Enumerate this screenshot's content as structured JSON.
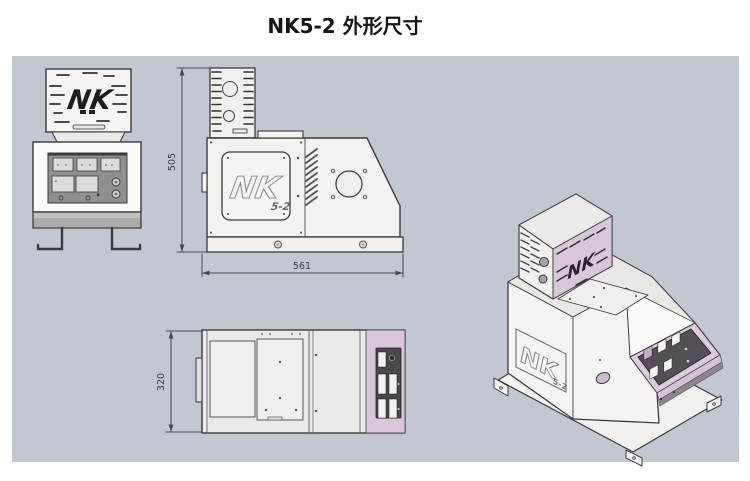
{
  "title": "NK5-2 外形尺寸",
  "brand": {
    "logo": "NK",
    "model": "5-2"
  },
  "dimensions": {
    "height": "505",
    "width": "561",
    "depth": "320"
  },
  "colors": {
    "canvas": "#c3c7d1",
    "lavender": "#d8c7da",
    "panel_gray": "#8f8f8d",
    "dark_panel": "#4b4947",
    "line": "#3b3b3b"
  }
}
